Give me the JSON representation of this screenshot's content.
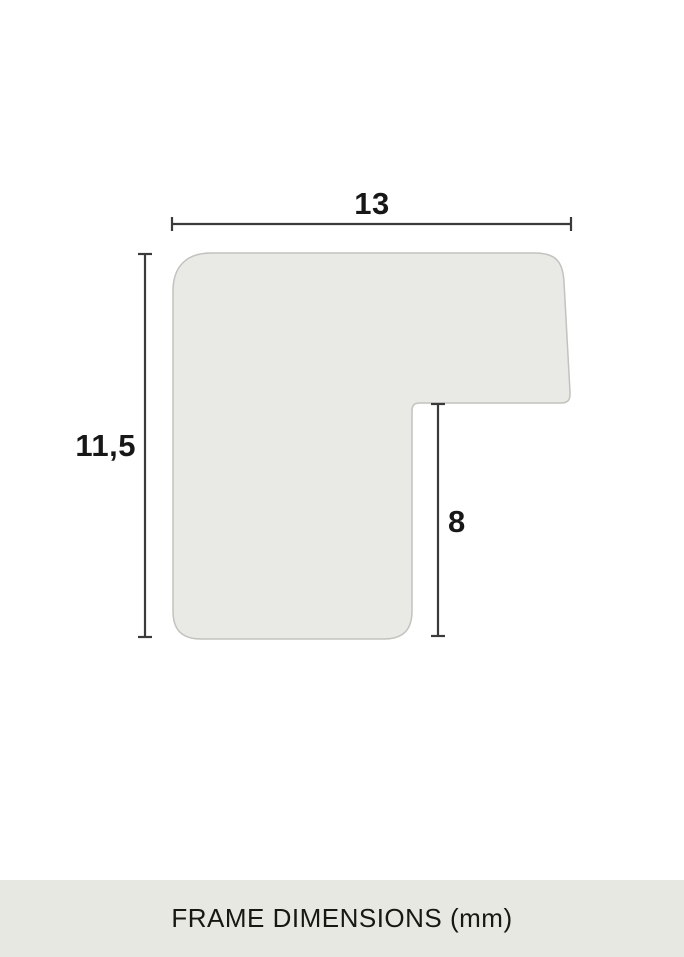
{
  "diagram": {
    "kind": "frame-moulding-cross-section",
    "shape_fill": "#e9e9e5",
    "shape_stroke": "#c2c2be",
    "dimension_line_color": "#3a3a3a",
    "dimensions": {
      "top_width": {
        "value": "13",
        "unit": "mm"
      },
      "left_height": {
        "value": "11,5",
        "unit": "mm"
      },
      "notch_depth": {
        "value": "8",
        "unit": "mm"
      }
    }
  },
  "footer": {
    "label": "FRAME DIMENSIONS (mm)",
    "background": "#e8e8e3"
  }
}
